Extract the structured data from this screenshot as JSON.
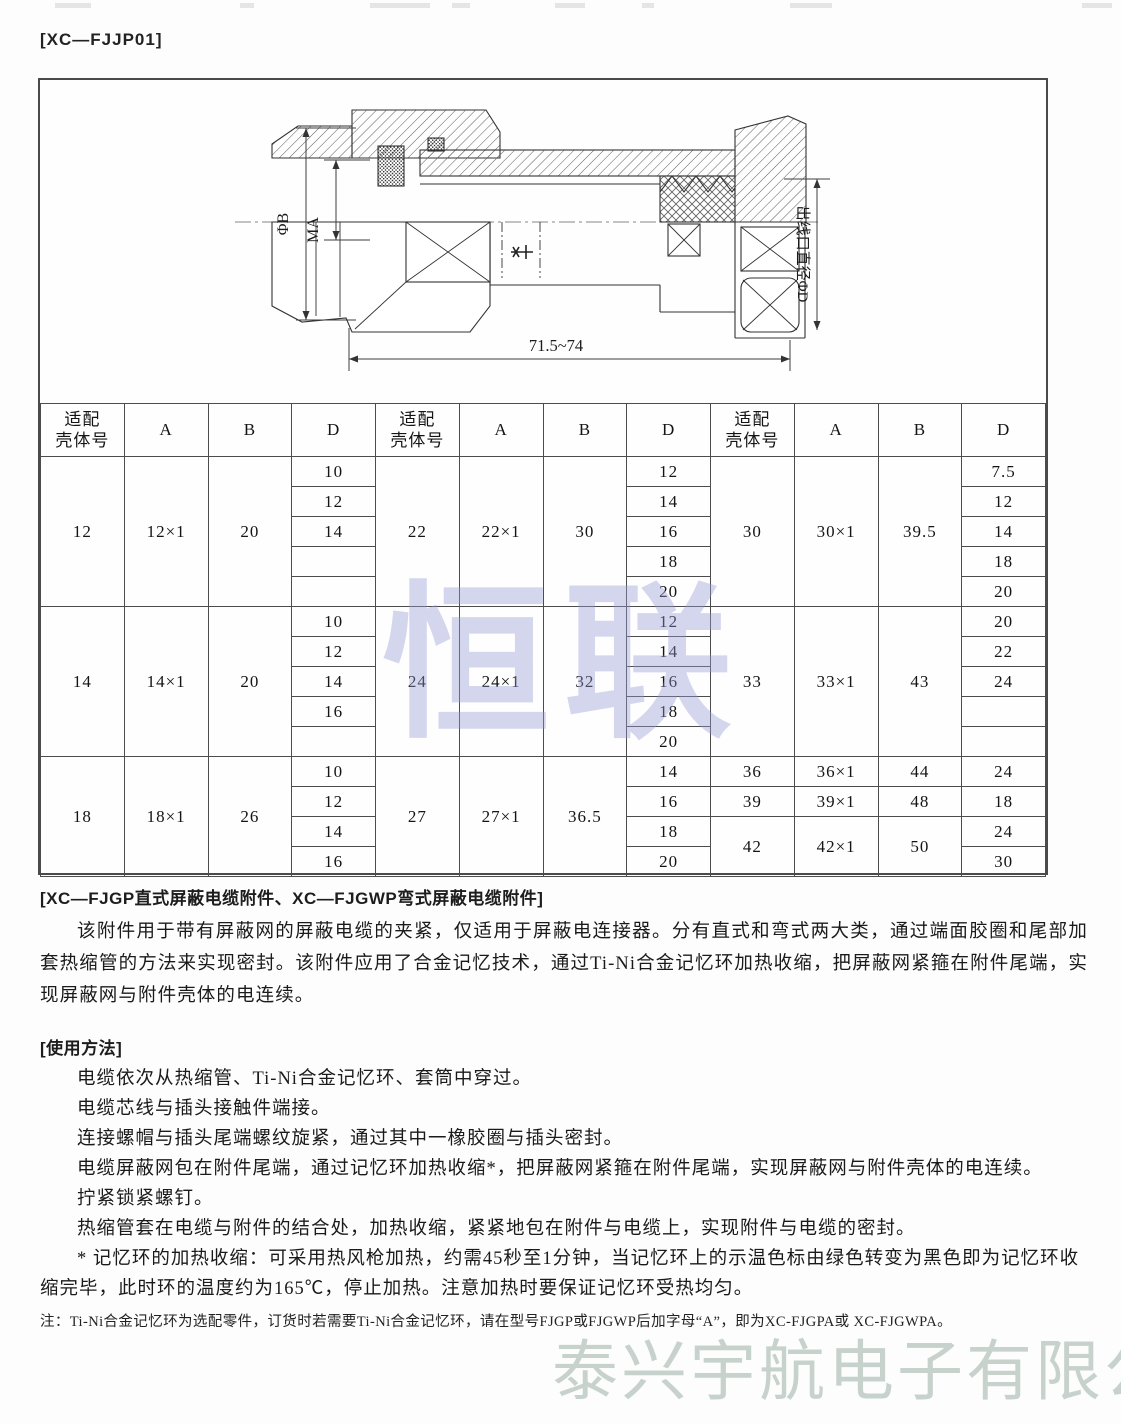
{
  "page_label": "[XC—FJJP01]",
  "diagram": {
    "dim_phi_b": "ΦB",
    "dim_ma": "MA",
    "dim_outlet": "出线口直径ΦD",
    "dim_length": "71.5~74"
  },
  "table": {
    "header": [
      "适配\n壳体号",
      "A",
      "B",
      "D",
      "适配\n壳体号",
      "A",
      "B",
      "D",
      "适配\n壳体号",
      "A",
      "B",
      "D"
    ],
    "rows": [
      [
        {
          "v": "12",
          "rs": 5
        },
        {
          "v": "12×1",
          "rs": 5
        },
        {
          "v": "20",
          "rs": 5
        },
        {
          "v": "10"
        },
        {
          "v": "22",
          "rs": 5
        },
        {
          "v": "22×1",
          "rs": 5
        },
        {
          "v": "30",
          "rs": 5
        },
        {
          "v": "12"
        },
        {
          "v": "30",
          "rs": 5
        },
        {
          "v": "30×1",
          "rs": 5
        },
        {
          "v": "39.5",
          "rs": 5
        },
        {
          "v": "7.5"
        }
      ],
      [
        {
          "v": "12"
        },
        {
          "v": "14"
        },
        {
          "v": "12"
        }
      ],
      [
        {
          "v": "14"
        },
        {
          "v": "16"
        },
        {
          "v": "14"
        }
      ],
      [
        {
          "v": ""
        },
        {
          "v": "18"
        },
        {
          "v": "18"
        }
      ],
      [
        {
          "v": ""
        },
        {
          "v": "20"
        },
        {
          "v": "20"
        }
      ],
      [
        {
          "v": "14",
          "rs": 5
        },
        {
          "v": "14×1",
          "rs": 5
        },
        {
          "v": "20",
          "rs": 5
        },
        {
          "v": "10"
        },
        {
          "v": "24",
          "rs": 5
        },
        {
          "v": "24×1",
          "rs": 5
        },
        {
          "v": "32",
          "rs": 5
        },
        {
          "v": "12"
        },
        {
          "v": "33",
          "rs": 5
        },
        {
          "v": "33×1",
          "rs": 5
        },
        {
          "v": "43",
          "rs": 5
        },
        {
          "v": "20"
        }
      ],
      [
        {
          "v": "12"
        },
        {
          "v": "14"
        },
        {
          "v": "22"
        }
      ],
      [
        {
          "v": "14"
        },
        {
          "v": "16"
        },
        {
          "v": "24"
        }
      ],
      [
        {
          "v": "16"
        },
        {
          "v": "18"
        },
        {
          "v": ""
        }
      ],
      [
        {
          "v": ""
        },
        {
          "v": "20"
        },
        {
          "v": ""
        }
      ],
      [
        {
          "v": "18",
          "rs": 4
        },
        {
          "v": "18×1",
          "rs": 4
        },
        {
          "v": "26",
          "rs": 4
        },
        {
          "v": "10"
        },
        {
          "v": "27",
          "rs": 4
        },
        {
          "v": "27×1",
          "rs": 4
        },
        {
          "v": "36.5",
          "rs": 4
        },
        {
          "v": "14"
        },
        {
          "v": "36"
        },
        {
          "v": "36×1"
        },
        {
          "v": "44"
        },
        {
          "v": "24"
        }
      ],
      [
        {
          "v": "12"
        },
        {
          "v": "16"
        },
        {
          "v": "39"
        },
        {
          "v": "39×1"
        },
        {
          "v": "48"
        },
        {
          "v": "18"
        }
      ],
      [
        {
          "v": "14"
        },
        {
          "v": "18"
        },
        {
          "v": "42",
          "rs": 2
        },
        {
          "v": "42×1",
          "rs": 2
        },
        {
          "v": "50",
          "rs": 2
        },
        {
          "v": "24"
        }
      ],
      [
        {
          "v": "16"
        },
        {
          "v": "20"
        },
        {
          "v": "30"
        }
      ]
    ]
  },
  "sections": {
    "attachment_title": "[XC—FJGP直式屏蔽电缆附件、XC—FJGWP弯式屏蔽电缆附件]",
    "attachment_para": "该附件用于带有屏蔽网的屏蔽电缆的夹紧，仅适用于屏蔽电连接器。分有直式和弯式两大类，通过端面胶圈和尾部加套热缩管的方法来实现密封。该附件应用了合金记忆技术，通过Ti-Ni合金记忆环加热收缩，把屏蔽网紧箍在附件尾端，实现屏蔽网与附件壳体的电连续。",
    "usage_title": "[使用方法]",
    "usage_lines": [
      "电缆依次从热缩管、Ti-Ni合金记忆环、套筒中穿过。",
      "电缆芯线与插头接触件端接。",
      "连接螺帽与插头尾端螺纹旋紧，通过其中一橡胶圈与插头密封。",
      "电缆屏蔽网包在附件尾端，通过记忆环加热收缩*，把屏蔽网紧箍在附件尾端，实现屏蔽网与附件壳体的电连续。",
      "拧紧锁紧螺钉。",
      "热缩管套在电缆与附件的结合处，加热收缩，紧紧地包在附件与电缆上，实现附件与电缆的密封。",
      "* 记忆环的加热收缩：可采用热风枪加热，约需45秒至1分钟，当记忆环上的示温色标由绿色转变为黑色即为记忆环收缩完毕，此时环的温度约为165℃，停止加热。注意加热时要保证记忆环受热均匀。"
    ],
    "order_note": "注：Ti-Ni合金记忆环为选配零件，订货时若需要Ti-Ni合金记忆环，请在型号FJGP或FJGWP后加字母“A”，即为XC-FJGPA或 XC-FJGWPA。"
  },
  "watermarks": {
    "center": "恒联",
    "footer": "泰兴宇航电子有限公司"
  },
  "colors": {
    "line": "#333333",
    "table_border": "#4c4c4c",
    "watermark_center": "#969cd6",
    "watermark_footer": "#c7d2cd"
  }
}
